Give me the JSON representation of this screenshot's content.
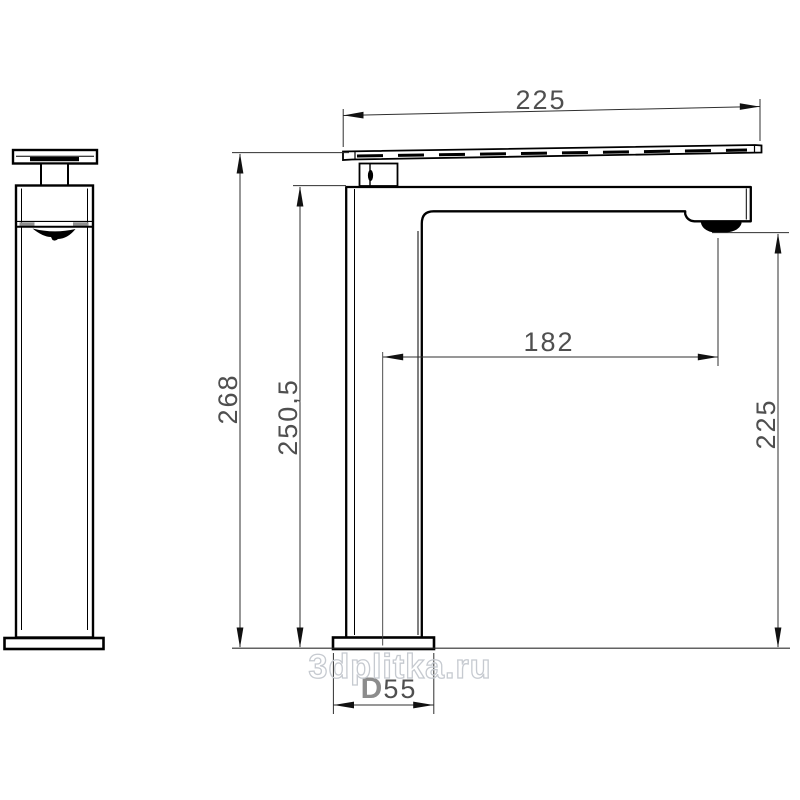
{
  "dimensions": {
    "top_width": "225",
    "overall_height": "268",
    "body_height": "250,5",
    "spout_reach": "182",
    "outlet_height": "225",
    "base_diameter_prefix": "D",
    "base_diameter_value": "55"
  },
  "watermark": "3dplitka.ru",
  "colors": {
    "line": "#000000",
    "dim_line": "#2f2f2f",
    "dim_text": "#4f4f4f",
    "diameter_prefix": "#8c8c8c",
    "watermark_stroke": "#c6cad0"
  }
}
